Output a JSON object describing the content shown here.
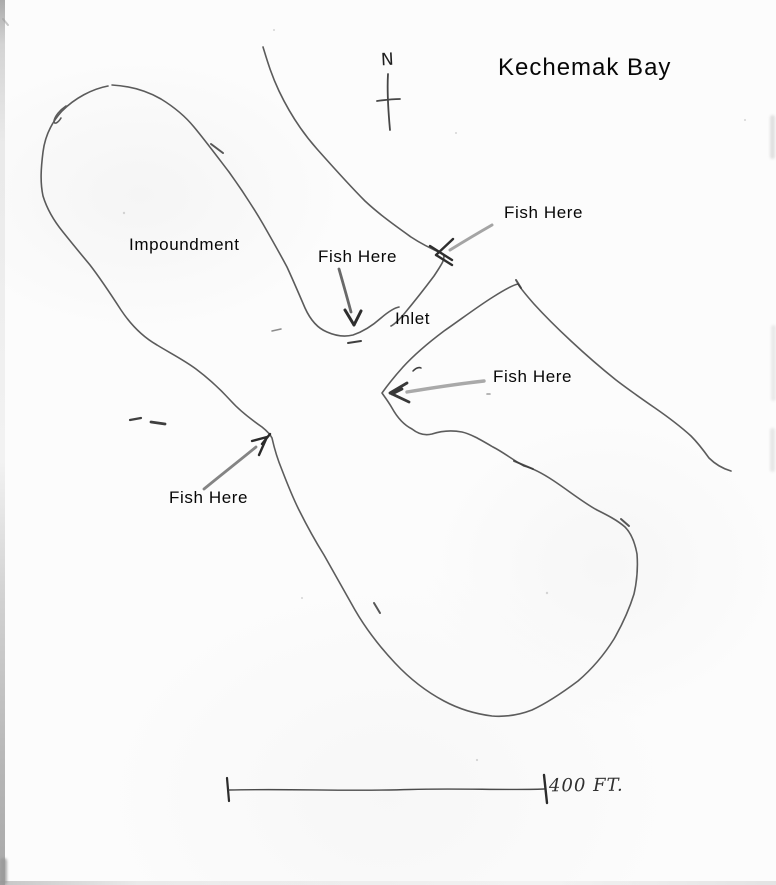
{
  "title": "Kechemak Bay",
  "compass": {
    "label": "N"
  },
  "labels": {
    "impoundment": "Impoundment",
    "inlet": "Inlet",
    "fish_here_bay_point": "Fish Here",
    "fish_here_cove": "Fish Here",
    "fish_here_peninsula_tip": "Fish Here",
    "fish_here_narrows": "Fish Here"
  },
  "scale_bar": {
    "label": "400 FT."
  },
  "colors": {
    "pencil": "#4a4a4a",
    "arrow_gray": "#8d8d8d",
    "label_ink": "#070707",
    "paper": "#fcfcfc"
  }
}
